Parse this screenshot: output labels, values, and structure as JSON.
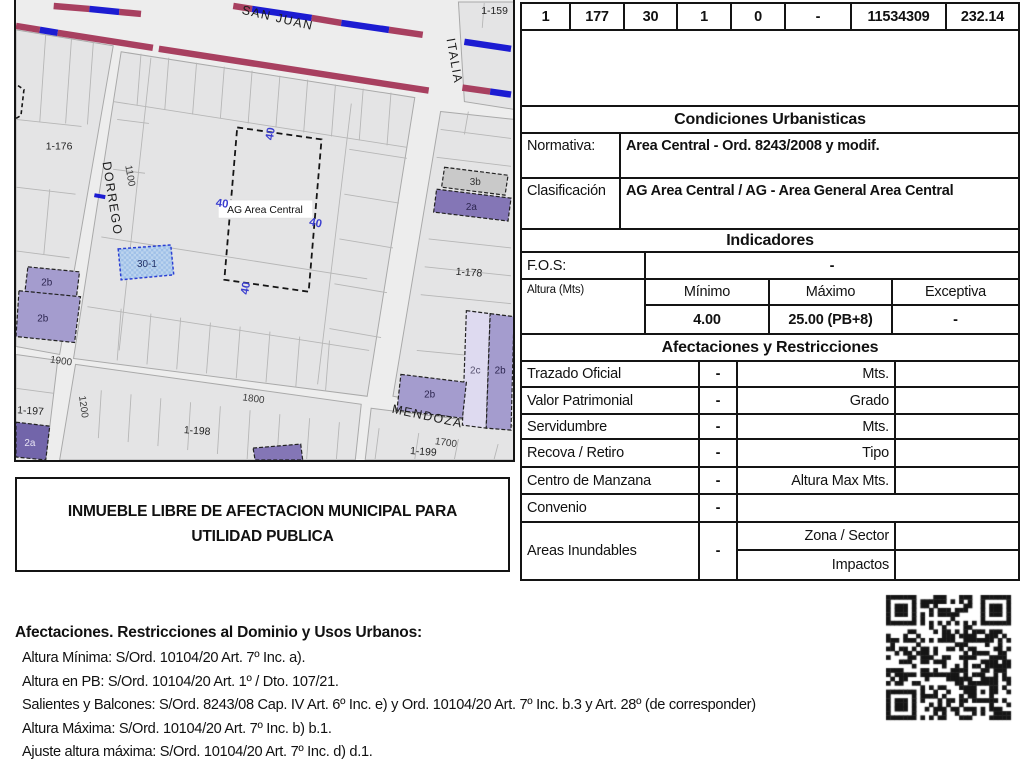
{
  "top_row": {
    "cells": [
      "1",
      "177",
      "30",
      "1",
      "0",
      "-",
      "11534309",
      "232.14"
    ]
  },
  "sections": {
    "condiciones": {
      "title": "Condiciones Urbanisticas",
      "rows": [
        {
          "label": "Normativa:",
          "value": "Area Central - Ord. 8243/2008 y modif."
        },
        {
          "label": "Clasificación",
          "value": "AG Area Central / AG - Area General Area Central"
        }
      ]
    },
    "indicadores": {
      "title": "Indicadores",
      "fos_label": "F.O.S:",
      "fos_value": "-",
      "altura_label": "Altura (Mts)",
      "altura_cols": [
        "Mínimo",
        "Máximo",
        "Exceptiva"
      ],
      "altura_values": [
        "4.00",
        "25.00 (PB+8)",
        "-"
      ]
    },
    "afectaciones": {
      "title": "Afectaciones y Restricciones",
      "rows": [
        {
          "label": "Trazado Oficial",
          "value": "-",
          "unit": "Mts."
        },
        {
          "label": "Valor Patrimonial",
          "value": "-",
          "unit": "Grado"
        },
        {
          "label": "Servidumbre",
          "value": "-",
          "unit": "Mts."
        },
        {
          "label": "Recova / Retiro",
          "value": "-",
          "unit": "Tipo"
        },
        {
          "label": "Centro de Manzana",
          "value": "-",
          "unit": "Altura Max Mts."
        },
        {
          "label": "Convenio",
          "value": "-",
          "unit": ""
        },
        {
          "label": "Areas Inundables",
          "value": "-",
          "unit": "Zona / Sector",
          "unit2": "Impactos"
        }
      ]
    }
  },
  "notice": {
    "text": "INMUEBLE LIBRE DE AFECTACION MUNICIPAL PARA UTILIDAD PUBLICA"
  },
  "footer": {
    "title": "Afectaciones. Restricciones al Dominio y Usos Urbanos:",
    "lines": [
      "Altura Mínima: S/Ord. 10104/20 Art. 7º Inc. a).",
      "Altura en PB: S/Ord. 10104/20 Art. 1º / Dto. 107/21.",
      "Salientes y Balcones: S/Ord. 8243/08 Cap. IV Art. 6º Inc. e) y Ord. 10104/20 Art. 7º Inc. b.3 y Art. 28º (de corresponder)",
      "Altura Máxima: S/Ord. 10104/20 Art. 7º Inc. b) b.1.",
      "Ajuste altura máxima: S/Ord. 10104/20 Art. 7º Inc. d) d.1."
    ]
  },
  "map": {
    "streets": [
      {
        "name": "SAN JUAN"
      },
      {
        "name": "ITALIA"
      },
      {
        "name": "DORREGO"
      },
      {
        "name": "MENDOZA"
      }
    ],
    "block_numbers": [
      {
        "text": "1100"
      },
      {
        "text": "1200"
      },
      {
        "text": "1900"
      },
      {
        "text": "1800"
      },
      {
        "text": "1700"
      }
    ],
    "parcel_ids": [
      {
        "text": "1-176"
      },
      {
        "text": "1-159"
      },
      {
        "text": "1-178"
      },
      {
        "text": "1-197"
      },
      {
        "text": "1-198"
      },
      {
        "text": "1-199"
      }
    ],
    "zone_labels": [
      {
        "text": "2b"
      },
      {
        "text": "2b"
      },
      {
        "text": "2a"
      },
      {
        "text": "3b"
      },
      {
        "text": "2a"
      },
      {
        "text": "2c"
      },
      {
        "text": "2b"
      },
      {
        "text": "2b"
      }
    ],
    "forty_labels": [
      {
        "text": "40"
      },
      {
        "text": "40"
      },
      {
        "text": "40"
      },
      {
        "text": "40"
      }
    ],
    "area_label": "AG Area Central",
    "selected_parcel": "30-1"
  },
  "colors": {
    "band_red": "#a84060",
    "band_blue": "#1c1cd2",
    "zone_dark": "#7265aa",
    "zone_mid": "#8476b6",
    "zone_soft": "#a49cce",
    "zone_pale": "#dedaf0",
    "zone_gray": "#c9c9c9",
    "sel_blue": "#3b3ecf",
    "hatch_fill": "#bcd4ee",
    "hatch_line": "#9fc0e8",
    "hatch_border": "#2a3fd4",
    "map_bg": "#ededed",
    "block_fill": "#e4e4e5",
    "block_line": "#a9a9a9",
    "ink": "#111111"
  }
}
